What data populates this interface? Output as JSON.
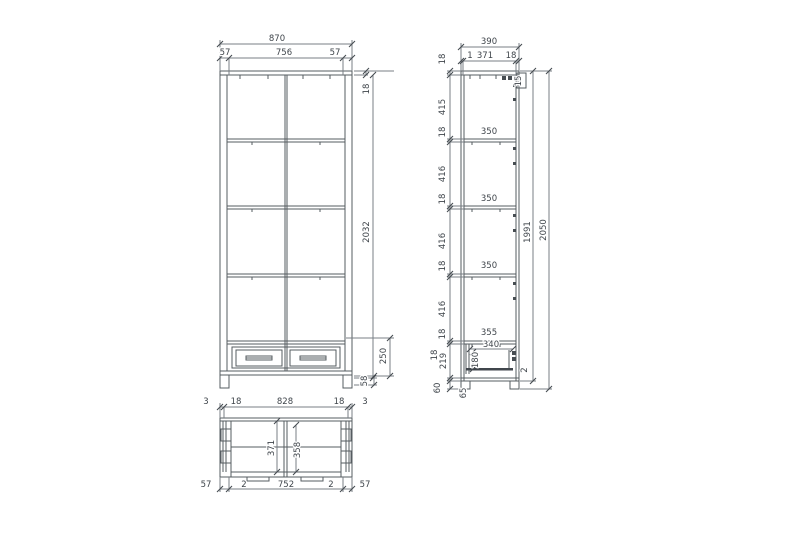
{
  "drawing": {
    "type": "furniture-technical-drawing",
    "colors": {
      "background": "#ffffff",
      "line": "#565c61",
      "text": "#3f454b"
    }
  },
  "views": {
    "front": {
      "name": "front-elevation",
      "labels": [
        {
          "text": "870",
          "x": 277,
          "y": 41,
          "rot": 0
        },
        {
          "text": "57",
          "x": 225,
          "y": 55,
          "rot": 0
        },
        {
          "text": "756",
          "x": 284,
          "y": 55,
          "rot": 0
        },
        {
          "text": "57",
          "x": 335,
          "y": 55,
          "rot": 0
        },
        {
          "text": "18",
          "x": 369,
          "y": 89,
          "rot": 90
        },
        {
          "text": "2032",
          "x": 369,
          "y": 232,
          "rot": 90
        },
        {
          "text": "250",
          "x": 386,
          "y": 356,
          "rot": 90
        },
        {
          "text": "58",
          "x": 367,
          "y": 381,
          "rot": 90
        }
      ]
    },
    "plan": {
      "name": "plan-section",
      "labels": [
        {
          "text": "3",
          "x": 206,
          "y": 404,
          "rot": 0
        },
        {
          "text": "18",
          "x": 236,
          "y": 404,
          "rot": 0
        },
        {
          "text": "828",
          "x": 285,
          "y": 404,
          "rot": 0
        },
        {
          "text": "18",
          "x": 339,
          "y": 404,
          "rot": 0
        },
        {
          "text": "3",
          "x": 365,
          "y": 404,
          "rot": 0
        },
        {
          "text": "371",
          "x": 274,
          "y": 448,
          "rot": 90
        },
        {
          "text": "358",
          "x": 300,
          "y": 450,
          "rot": 90
        },
        {
          "text": "57",
          "x": 206,
          "y": 487,
          "rot": 0
        },
        {
          "text": "2",
          "x": 244,
          "y": 487,
          "rot": 0
        },
        {
          "text": "752",
          "x": 286,
          "y": 487,
          "rot": 0
        },
        {
          "text": "2",
          "x": 331,
          "y": 487,
          "rot": 0
        },
        {
          "text": "57",
          "x": 365,
          "y": 487,
          "rot": 0
        }
      ]
    },
    "side": {
      "name": "side-section",
      "labels": [
        {
          "text": "390",
          "x": 489,
          "y": 44,
          "rot": 0
        },
        {
          "text": "1",
          "x": 470,
          "y": 58,
          "rot": 0
        },
        {
          "text": "371",
          "x": 485,
          "y": 58,
          "rot": 0
        },
        {
          "text": "18",
          "x": 511,
          "y": 58,
          "rot": 0
        },
        {
          "text": "18",
          "x": 445,
          "y": 59,
          "rot": 90
        },
        {
          "text": "15",
          "x": 521,
          "y": 81,
          "rot": 90
        },
        {
          "text": "415",
          "x": 445,
          "y": 107,
          "rot": 90
        },
        {
          "text": "18",
          "x": 445,
          "y": 132,
          "rot": 90
        },
        {
          "text": "350",
          "x": 489,
          "y": 134,
          "rot": 0
        },
        {
          "text": "416",
          "x": 445,
          "y": 174,
          "rot": 90
        },
        {
          "text": "18",
          "x": 445,
          "y": 199,
          "rot": 90
        },
        {
          "text": "350",
          "x": 489,
          "y": 201,
          "rot": 0
        },
        {
          "text": "416",
          "x": 445,
          "y": 241,
          "rot": 90
        },
        {
          "text": "18",
          "x": 445,
          "y": 266,
          "rot": 90
        },
        {
          "text": "350",
          "x": 489,
          "y": 268,
          "rot": 0
        },
        {
          "text": "416",
          "x": 445,
          "y": 309,
          "rot": 90
        },
        {
          "text": "18",
          "x": 445,
          "y": 334,
          "rot": 90
        },
        {
          "text": "355",
          "x": 489,
          "y": 335,
          "rot": 0
        },
        {
          "text": "340",
          "x": 491,
          "y": 347,
          "rot": 0
        },
        {
          "text": "180",
          "x": 478,
          "y": 360,
          "rot": 90
        },
        {
          "text": "219",
          "x": 446,
          "y": 361,
          "rot": 90
        },
        {
          "text": "18",
          "x": 437,
          "y": 355,
          "rot": 90
        },
        {
          "text": "60",
          "x": 440,
          "y": 388,
          "rot": 90
        },
        {
          "text": "65",
          "x": 466,
          "y": 393,
          "rot": 90
        },
        {
          "text": "2",
          "x": 527,
          "y": 370,
          "rot": 90
        },
        {
          "text": "1991",
          "x": 530,
          "y": 232,
          "rot": 90
        },
        {
          "text": "2050",
          "x": 546,
          "y": 230,
          "rot": 90
        }
      ]
    }
  }
}
